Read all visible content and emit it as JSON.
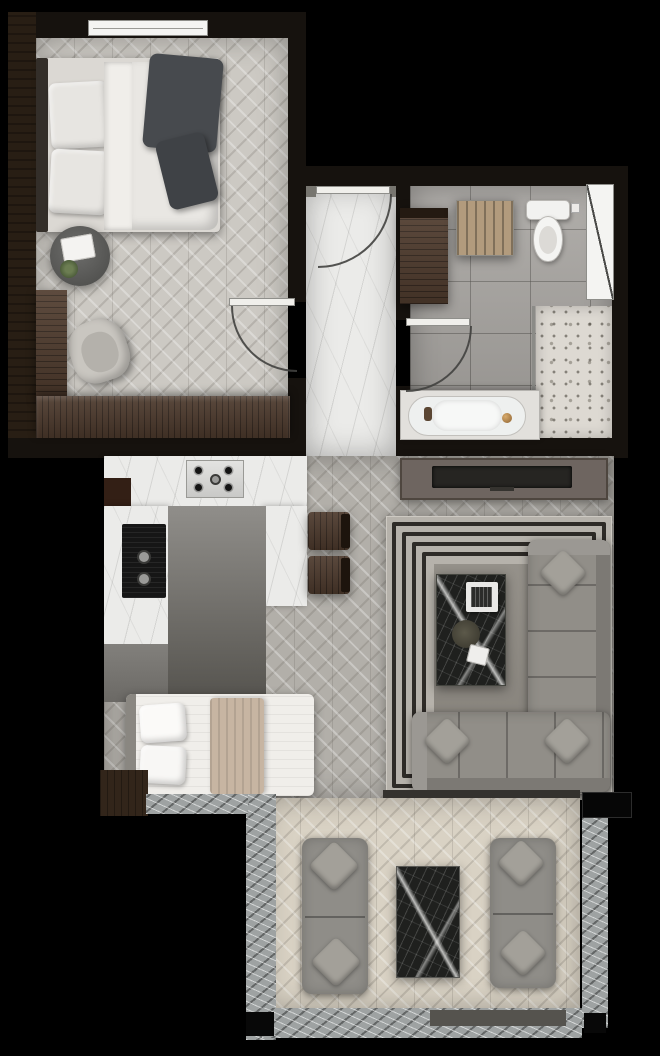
{
  "meta": {
    "title": "Apartment floor plan — rendered top view",
    "canvas_width": 660,
    "canvas_height": 1056,
    "background": "#000000"
  },
  "palette": {
    "wall_dark": "#16120e",
    "wall_brown": "#281e14",
    "floor_bedroom": "#ccc9c3",
    "floor_hall_marble": "#ebebe9",
    "floor_bath_tile": "#a8a5a1",
    "floor_shower_mosaic": "#ddd9d2",
    "floor_living": "#b2afa9",
    "floor_balcony": "#d9d2c4",
    "kitchen_floor_dark": "#6f6d68",
    "wood": "#4c392c",
    "wood_mat": "#b29b7d",
    "fixture_white": "#f2f2f0",
    "sofa_gray": "#918e88",
    "rug_band_dark": "#2e2b27",
    "rug_field": "#8e8a83",
    "marble_dark": "#1f201e",
    "marble_border": "#9ea2a2",
    "cooktop_steel": "#d9d9d7",
    "faucet_gold": "#b8894d",
    "plant_green": "#5f7048",
    "throw_blanket": "#474a4e",
    "daybed_blanket": "#c7b5a2"
  },
  "rooms": {
    "bedroom": {
      "label": "Bedroom",
      "items": {
        "bed": "Double bed",
        "headboard": "Headboard",
        "pillow_1": "Pillow",
        "pillow_2": "Pillow",
        "sheet": "Folded sheet",
        "duvet": "Duvet",
        "throw": "Dark throw blanket",
        "side_table": "Round bedside table",
        "book": "Open book",
        "plant": "Potted plant",
        "armchair": "Armchair",
        "wardrobe": "Wardrobe",
        "dresser": "Low dresser",
        "window": "Window",
        "door": "Bedroom door"
      }
    },
    "hallway": {
      "label": "Entry hall",
      "items": {
        "floor": "Marble floor",
        "entry_door": "Entry door"
      }
    },
    "bathroom": {
      "label": "Bathroom",
      "items": {
        "cabinet": "Storage cabinet",
        "mat": "Wooden bath mat",
        "toilet": "Toilet",
        "bathtub": "Bathtub",
        "faucet": "Gold faucet",
        "shower": "Walk-in shower",
        "glass": "Glass screen",
        "window": "Window",
        "door": "Bathroom door"
      }
    },
    "kitchen": {
      "label": "Kitchen",
      "items": {
        "counter_top": "Kitchen counter",
        "counter_left": "Kitchen counter",
        "counter_right": "Kitchen counter",
        "cooktop": "Gas cooktop",
        "oven": "Built-in oven",
        "stool_1": "Bar stool",
        "stool_2": "Bar stool",
        "daybed": "Single bed",
        "daybed_blanket": "Beige blanket",
        "daybed_pillow": "Pillow"
      }
    },
    "living_room": {
      "label": "Living room",
      "items": {
        "tv_console": "TV console",
        "tv": "Television",
        "rug": "Striped area rug",
        "sofa": "Corner sofa",
        "cushion": "Cushion",
        "coffee_table": "Marble coffee table",
        "tray": "Serving tray",
        "plant": "Table plant",
        "card": "Magazine"
      }
    },
    "balcony": {
      "label": "Balcony",
      "items": {
        "sofa_left": "Outdoor sofa",
        "sofa_right": "Outdoor sofa",
        "table": "Marble outdoor table",
        "border": "Stone border",
        "floor": "Deck floor",
        "cushion": "Cushion"
      }
    }
  }
}
